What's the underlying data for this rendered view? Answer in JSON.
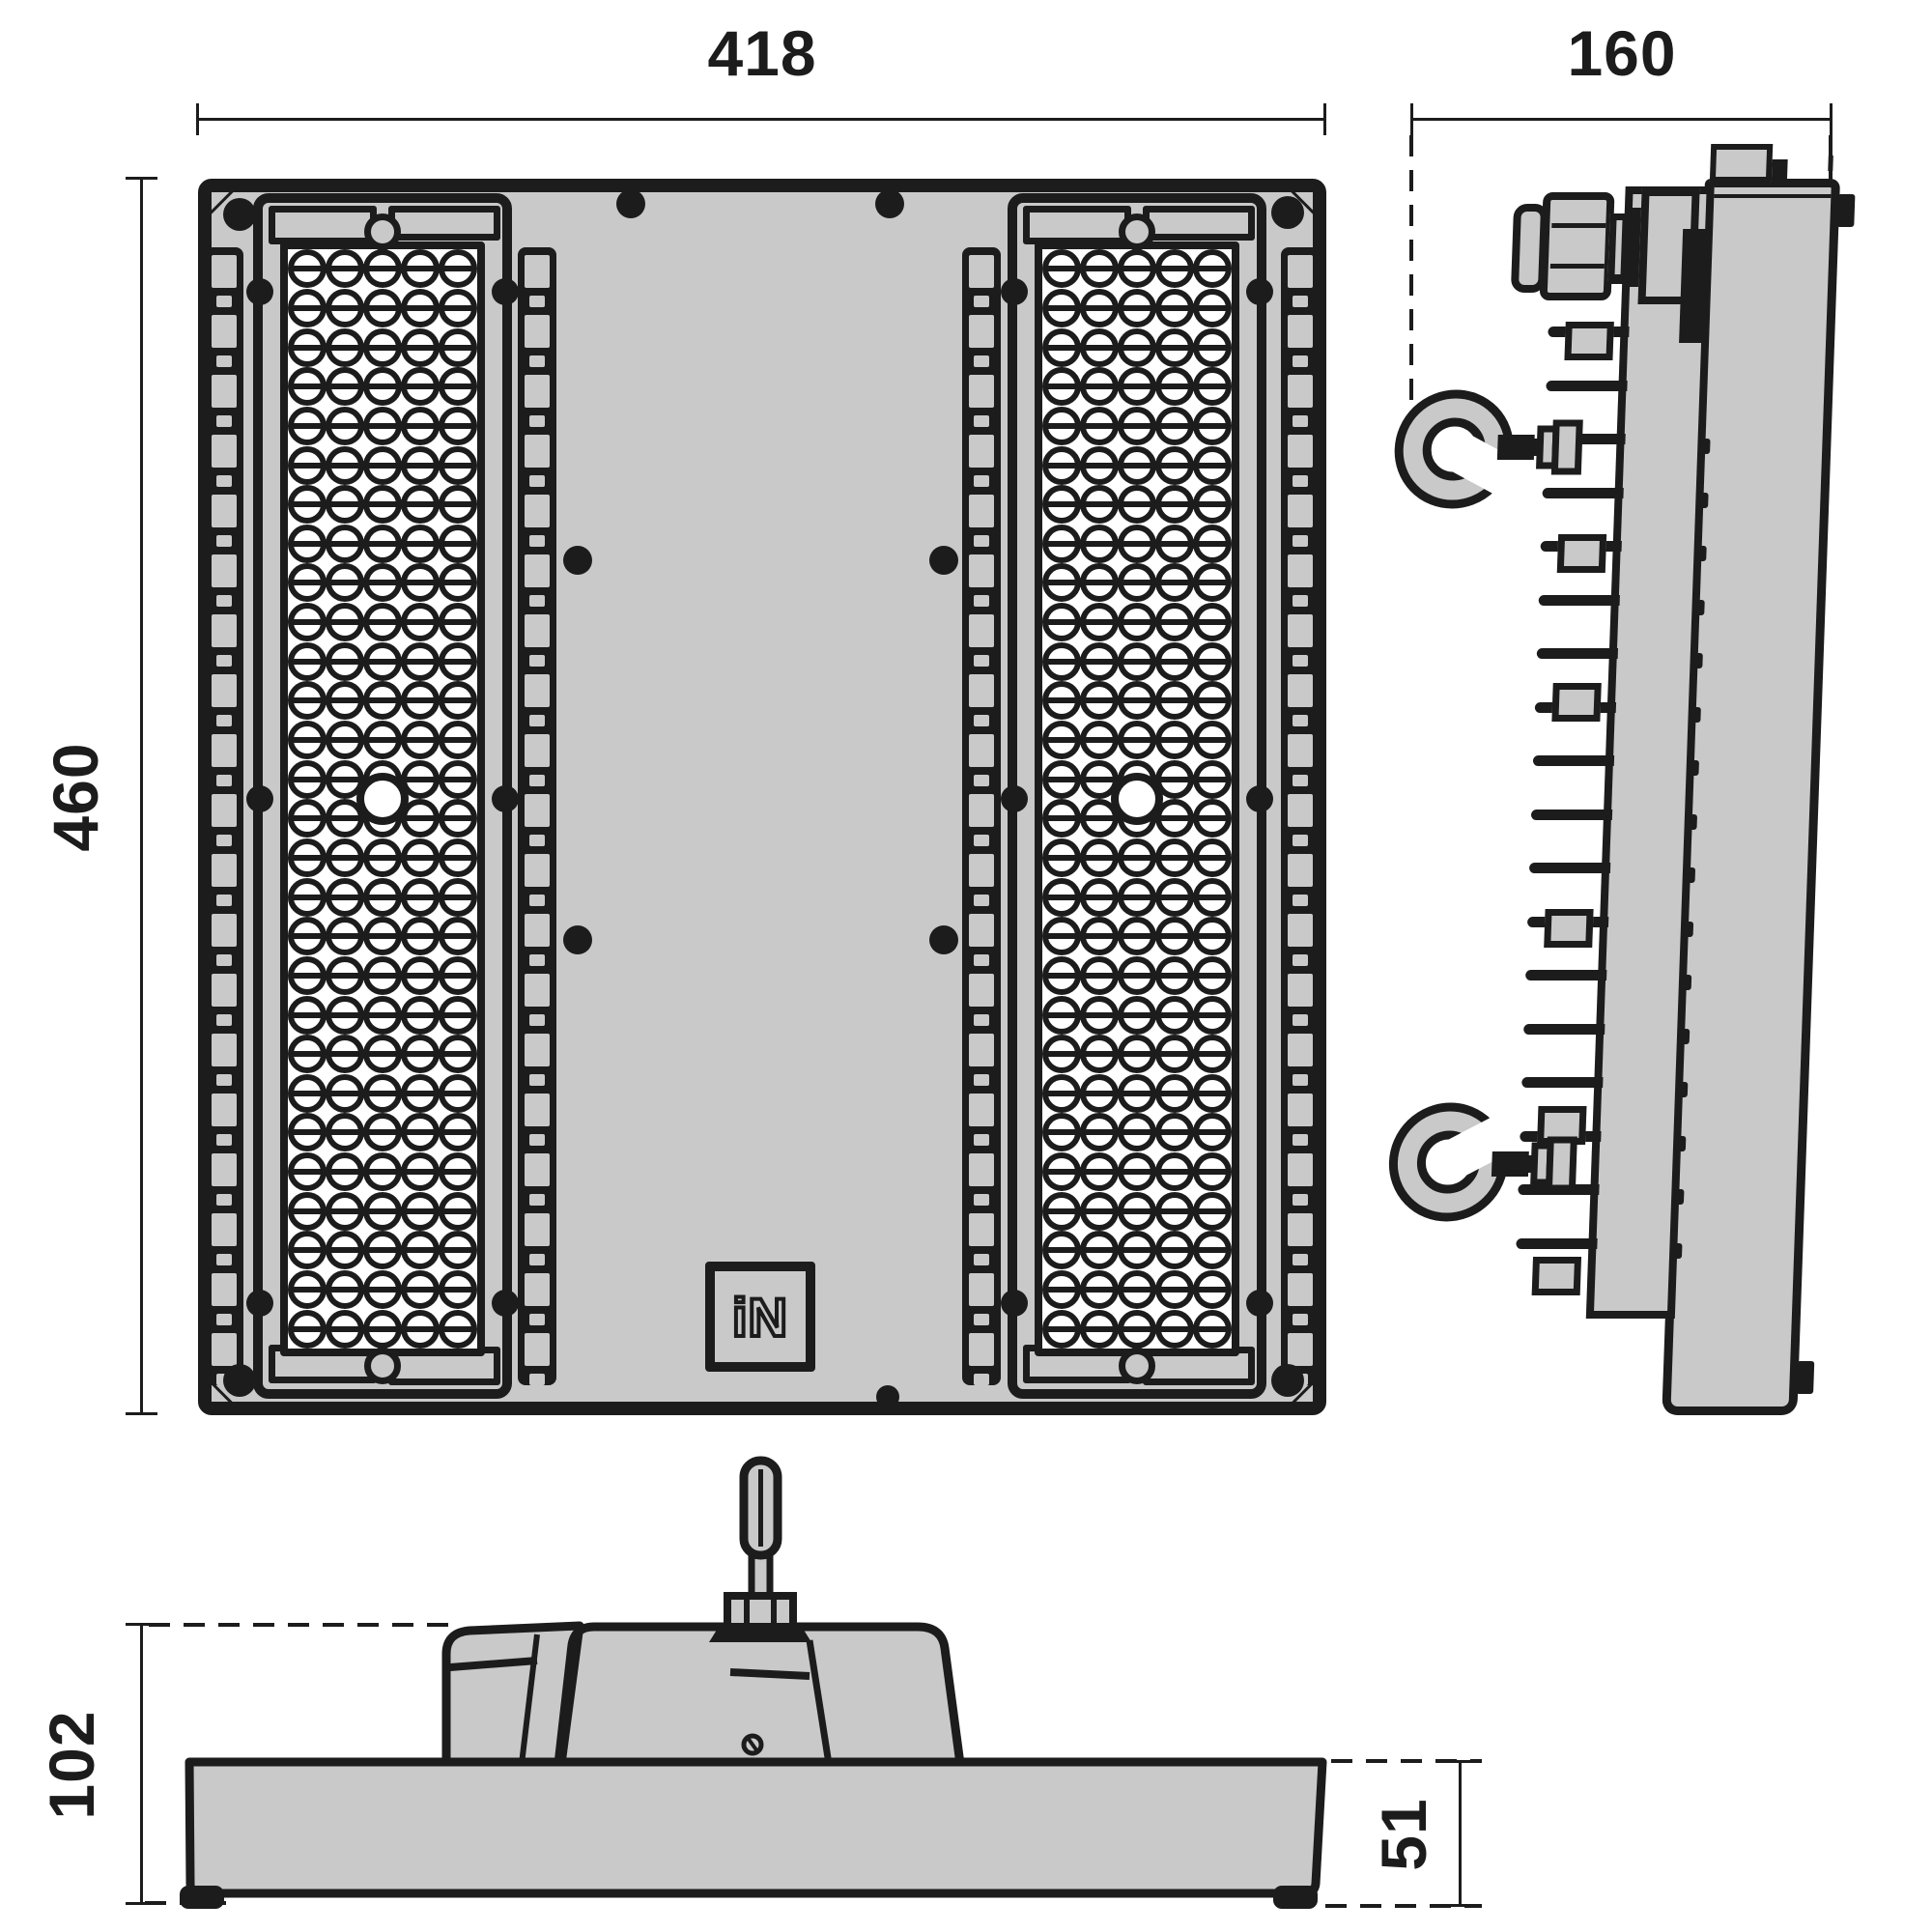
{
  "drawing": {
    "type": "technical-dimension-drawing",
    "subject": "LED high-bay floodlight luminaire, three orthographic views",
    "colors": {
      "line": "#1c1c1c",
      "fill": "#c9c9c9",
      "background": "#ffffff",
      "lens": "#ffffff"
    }
  },
  "dimensions": {
    "front_width": "418",
    "side_depth": "160",
    "front_height": "460",
    "bottom_total_height": "102",
    "bottom_body_height": "51"
  },
  "logo": {
    "text": "iN"
  },
  "front_view": {
    "led_module_count": 2,
    "led_columns": 5,
    "led_rows": 28,
    "rail_count": 4,
    "rail_segments": 19,
    "corner_screw_count": 4,
    "plate_screw_count": 7,
    "module_edge_screws_per_module": 6
  },
  "side_view": {
    "fin_count": 20,
    "fin_block_count": 6,
    "hook_count": 2,
    "edge_mark_count": 17,
    "has_cable_gland": true
  },
  "bottom_view": {
    "feet_count": 2,
    "has_eyebolt": true,
    "has_mounting_bracket": true
  }
}
